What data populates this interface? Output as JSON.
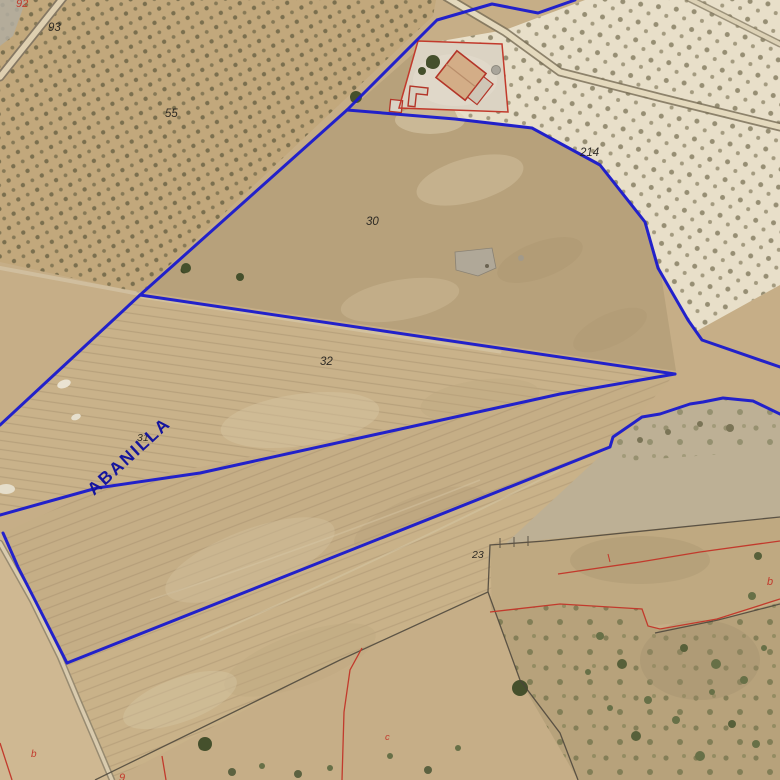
{
  "map": {
    "road_label": "ABANILLA",
    "parcel_labels": {
      "p93": "93",
      "p55": "55",
      "p30": "30",
      "p214": "214",
      "p32": "32",
      "p31": "31",
      "p23": "23"
    },
    "red_labels": {
      "top_92": "92",
      "bottom_left_b": "b",
      "bottom_left_9": "9",
      "center_c": "c",
      "right_b": "b"
    },
    "colors": {
      "parcel_outline_blue": "#1a1ace",
      "road_label_blue": "#15159d",
      "cadastral_red": "#c23a2c",
      "boundary_dark": "#4a443a",
      "terrain_tan": "#c6ae87",
      "terrain_pale": "#e8dfc9",
      "olive_dot": "#6d6546"
    }
  }
}
